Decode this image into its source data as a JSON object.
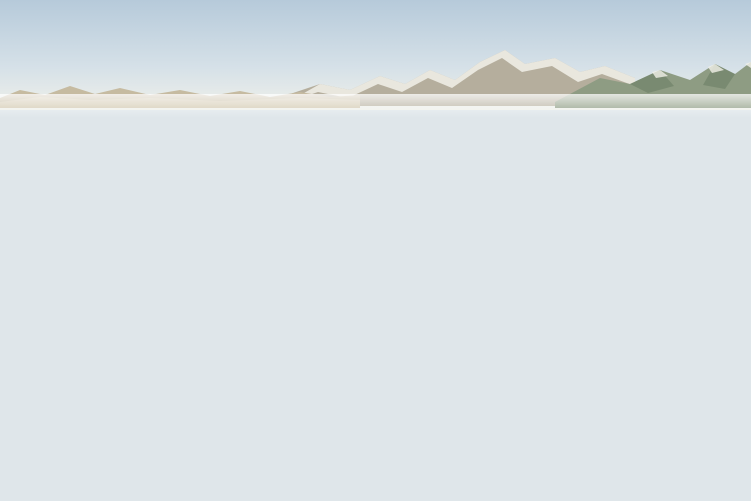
{
  "image": {
    "kind": "aerial-architectural-rendering",
    "subject": "Aerial rendering of a desert master-planned residential community: rows of flat-roof beige villas with lawns and tree-lined streets, a retail strip with palm-lined arcade and orange cafe umbrellas, a red-brown surface parking lot with parked cars, a wide boulevard with yellow center lines and crosswalks, poplar windbreak rows, farmland and snow-capped mountains in the distance"
  },
  "objects": {
    "mountain_ranges": [
      "left-tan-range",
      "central-snow-range",
      "right-green-range"
    ],
    "poplar_windbreak_count": 40,
    "foreground_tree_count": 12,
    "umbrella_count": 5,
    "parked_car_count": 24,
    "moving_car_count": 9,
    "retail_arcade_bay_count": 21,
    "residential_street_count": 7,
    "crosswalk_count": 2
  },
  "palette": {
    "sky_top": "#b6cada",
    "sky_mid": "#d6e1e8",
    "sky_horizon": "#eff0ea",
    "haze": "#eceee6",
    "mtn_far": "#b5ae9d",
    "mtn_snow": "#f2f1ea",
    "mtn_left": "#c6bba1",
    "mtn_left_inner": "#d4cbb1",
    "mtn_right": "#8e9c83",
    "mtn_right_shade": "#71836a",
    "field_base": "#cfc9ab",
    "field_green": "#a6bd88",
    "field_green2": "#9cb57e",
    "field_pale": "#d8d3b6",
    "field_tan": "#c7bc9c",
    "field_brown": "#ab8c6d",
    "crop_stripe": "#e6e6d4",
    "farm_road": "#ddd6bc",
    "orchard": "#4c6a3e",
    "belt_dark": "#49663c",
    "poplar_dark": "#3c6330",
    "poplar_mid": "#487439",
    "poplar_light": "#5d8a45",
    "poplar_trunk": "#6b5f48",
    "lawn": "#8fae63",
    "lawn_pale": "#b7b584",
    "street": "#8c8c86",
    "sidewalk": "#c6c2b4",
    "marking_white": "#eceae2",
    "curb": "#cfcabc",
    "house_wall": "#ddd2b7",
    "house_wall_lit": "#ebe2c8",
    "house_wall_warm": "#d4c6a6",
    "house_side": "#bdb092",
    "house_roofline": "#f0e8d0",
    "house_outline": "#8a8270",
    "window": "#3a382f",
    "strip_roof": "#cbc8bf",
    "strip_fascia": "#e9e7df",
    "roof_unit": "#b8b5ac",
    "canopy_dark": "#322e27",
    "canopy_glow": "#8a623c",
    "column": "#1f1c18",
    "pergola": "#4a4033",
    "banner_red": "#a33027",
    "palm": "#4c7838",
    "palm_trunk": "#9a8a66",
    "plaza": "#cfcaba",
    "umbrella": "#d96c2a",
    "parking": "#82513f",
    "parking2": "#8e5c49",
    "stripe": "#e8e4d8",
    "driveway": "#a8a49a",
    "road": "#8e8e8a",
    "road_dark": "#82827e",
    "lane_yellow": "#c9a23b",
    "shoulder": "#b3a87f",
    "median_gravel": "#c3b393",
    "shrub": "#6d8a4e",
    "shrub_olive": "#7c8a4a",
    "shrub_sage": "#9aa870",
    "shrub_rust": "#b06a38",
    "fg_grass": "#a8a671",
    "fg_grass_dark": "#7e8f55",
    "fg_shadow": "#4e5a3e",
    "fg_pale": "#c9c399",
    "tree_core": "#2f5529",
    "tree_mid": "#447233",
    "tree_hi": "#72a24e",
    "trunk": "#96866a",
    "car_white": "#f1f1ee",
    "car_silver": "#c6c6c4",
    "car_dark": "#333436",
    "car_red": "#8e2f27",
    "car_gray": "#8b8b89",
    "glass": "#46525c",
    "sign_red": "#9c2f26",
    "kiosk_green": "#3f7d4a",
    "kiosk_red": "#b84a2e",
    "people_dark": "#2e2a24"
  }
}
